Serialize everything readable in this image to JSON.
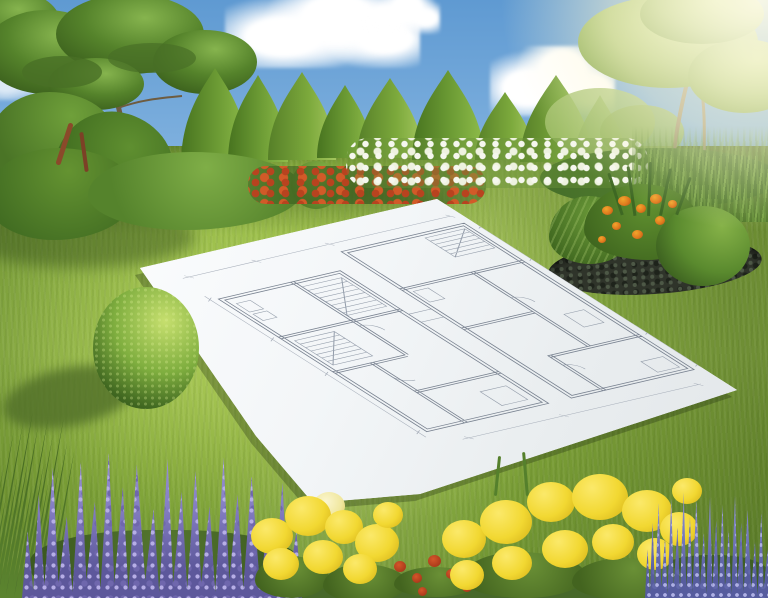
{
  "scene": {
    "description": "Photorealistic 3D rendering of a landscaped garden: a large white architectural floor-plan sheet lies flat on a sunlit lawn, surrounded by flower borders, conical hedge trees and a blue sky with clouds and sun glare from the upper right.",
    "elements": [
      "blue sky with white clouds",
      "sun glare in top-right corner",
      "spreading deciduous tree on the left",
      "row of conical clipped trees",
      "spreading tree washed in sunlight on the right",
      "tropical foliage border with red accents on the left",
      "shrub border with red and white flowers",
      "ornamental grasses on the right",
      "bright green lawn",
      "spherical boxwood topiary with cast shadow",
      "island flower bed with dark mulch, hosta, orange flowers and clipped dome bush",
      "white blueprint sheet with hand-drawn floor plan",
      "purple lavender flower spikes (left and right foreground)",
      "yellow yarrow flower clusters",
      "small red flowers",
      "dark grass blades in the left foreground"
    ]
  },
  "palette": {
    "sky_top": "#5f9ad2",
    "sky_horizon": "#cde4f4",
    "cloud": "#ffffff",
    "sun_glow": "#fff8dc",
    "tree_green": "#5d8c31",
    "tree_light": "#86b348",
    "tree_dark": "#3e651e",
    "trunk": "#6e5c40",
    "lawn_bright": "#93b845",
    "lawn_mid": "#84a93a",
    "lawn_dark": "#6d9231",
    "lawn_shadow": "#4f6d28",
    "mulch": "#2f342a",
    "paper_bright": "#fcfdfe",
    "paper_shade": "#e2e6e9",
    "plan_line": "#7e8795",
    "plan_line_dark": "#6b7585",
    "lavender": "#8781c6",
    "lavender_dark": "#5d589b",
    "yellow_flower": "#f2d832",
    "yellow_deep": "#d2ae15",
    "orange_flower": "#e07a1e",
    "red_flower": "#b8431f",
    "white_flower": "#f5f7ee"
  }
}
